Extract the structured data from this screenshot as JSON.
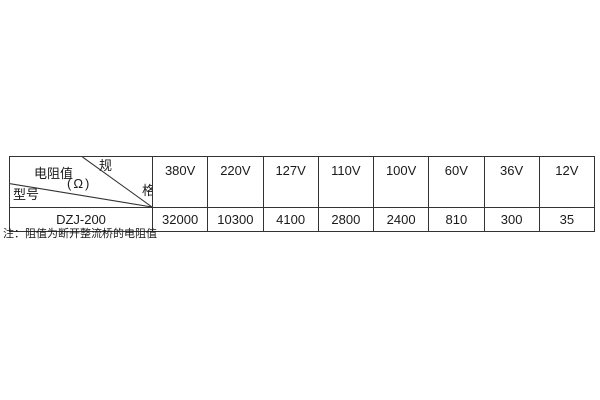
{
  "colors": {
    "background": "#ffffff",
    "border": "#333333",
    "text": "#1a1a1a"
  },
  "table": {
    "corner": {
      "spec_char_top": "规",
      "spec_char_bottom": "格",
      "value_label": "电阻值",
      "unit_label": "(Ω)",
      "model_label": "型号"
    },
    "columns": [
      "380V",
      "220V",
      "127V",
      "110V",
      "100V",
      "60V",
      "36V",
      "12V"
    ],
    "rows": [
      {
        "model": "DZJ-200",
        "values": [
          "32000",
          "10300",
          "4100",
          "2800",
          "2400",
          "810",
          "300",
          "35"
        ]
      }
    ]
  },
  "note": "注：阻值为断开整流桥的电阻值"
}
